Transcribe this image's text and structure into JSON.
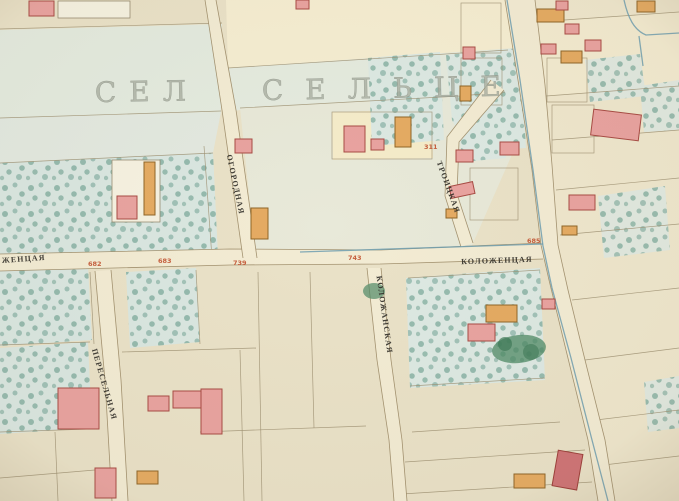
{
  "map": {
    "settlement_labels": {
      "left": "СЕЛ",
      "right": "СЕЛЬЦЕ"
    },
    "streets": [
      {
        "id": "ogorodnaya",
        "name": "ОГОРОДНАЯ"
      },
      {
        "id": "troitskaya",
        "name": "ТРОИЦКАЯ"
      },
      {
        "id": "kolozhenskaya",
        "name": "КОЛОЖЕНЦАЯ"
      },
      {
        "id": "kolozhenskaya-partial",
        "name": "ЖЕНЦАЯ"
      },
      {
        "id": "kolozhanskaya",
        "name": "КОЛОЖАНСКАЯ"
      },
      {
        "id": "pereselnaya",
        "name": "ПЕРЕСЕЛЬНАЯ"
      }
    ],
    "plot_numbers": [
      "682",
      "683",
      "739",
      "743",
      "685",
      "311"
    ],
    "colors": {
      "paper": "#eae2c8",
      "block_green": "#e4ebdf",
      "block_blue": "#dce8e2",
      "block_yellow": "#f6eed2",
      "street": "#f3ecd4",
      "building_pink": "#e9a3a0",
      "building_orange": "#e5ab62",
      "stream_blue": "#6f9fb0",
      "number_red": "#c2502e",
      "tree_green": "#4f8d7b"
    }
  }
}
